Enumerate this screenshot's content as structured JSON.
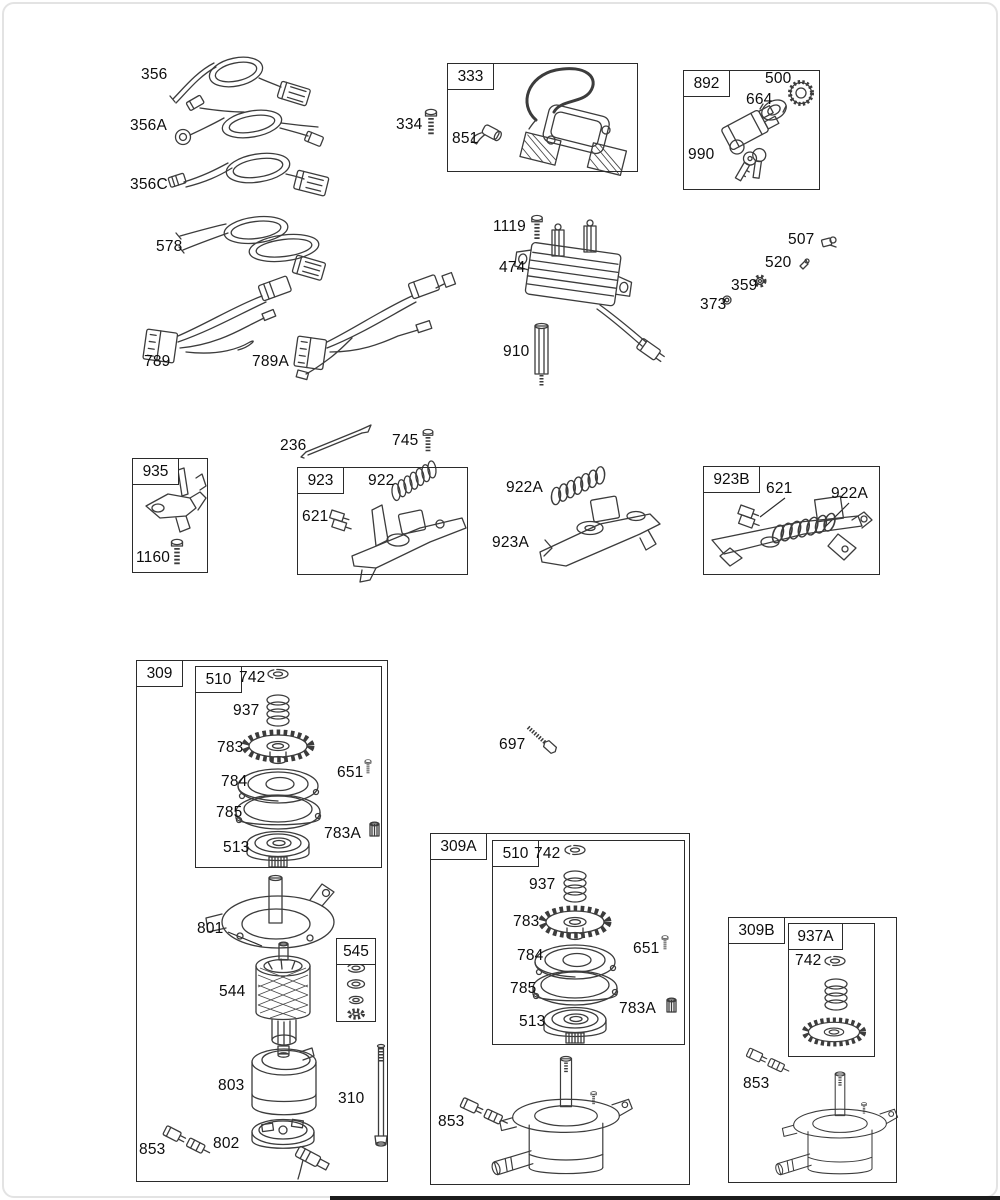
{
  "colors": {
    "ink": "#3c3c3c",
    "label_text": "#0d0d0d",
    "box_border": "#2b2b2b"
  },
  "labels": [
    {
      "id": "356",
      "text": "356",
      "x": 141,
      "y": 66
    },
    {
      "id": "356a",
      "text": "356A",
      "x": 130,
      "y": 117
    },
    {
      "id": "356c",
      "text": "356C",
      "x": 130,
      "y": 176
    },
    {
      "id": "578",
      "text": "578",
      "x": 156,
      "y": 238
    },
    {
      "id": "334",
      "text": "334",
      "x": 396,
      "y": 116
    },
    {
      "id": "851",
      "text": "851",
      "x": 452,
      "y": 130
    },
    {
      "id": "500",
      "text": "500",
      "x": 765,
      "y": 70
    },
    {
      "id": "664",
      "text": "664",
      "x": 746,
      "y": 91
    },
    {
      "id": "990",
      "text": "990",
      "x": 688,
      "y": 146
    },
    {
      "id": "1119",
      "text": "1119",
      "x": 493,
      "y": 218
    },
    {
      "id": "474",
      "text": "474",
      "x": 499,
      "y": 259
    },
    {
      "id": "910",
      "text": "910",
      "x": 503,
      "y": 343
    },
    {
      "id": "507",
      "text": "507",
      "x": 788,
      "y": 231
    },
    {
      "id": "520",
      "text": "520",
      "x": 765,
      "y": 254
    },
    {
      "id": "359",
      "text": "359",
      "x": 731,
      "y": 277
    },
    {
      "id": "373",
      "text": "373",
      "x": 700,
      "y": 296
    },
    {
      "id": "789",
      "text": "789",
      "x": 144,
      "y": 353
    },
    {
      "id": "789a",
      "text": "789A",
      "x": 252,
      "y": 353
    },
    {
      "id": "236",
      "text": "236",
      "x": 280,
      "y": 437
    },
    {
      "id": "745",
      "text": "745",
      "x": 392,
      "y": 432
    },
    {
      "id": "1160",
      "text": "1160",
      "x": 136,
      "y": 549
    },
    {
      "id": "922",
      "text": "922",
      "x": 368,
      "y": 472
    },
    {
      "id": "621-923",
      "text": "621",
      "x": 302,
      "y": 508
    },
    {
      "id": "922a",
      "text": "922A",
      "x": 506,
      "y": 479
    },
    {
      "id": "923a",
      "text": "923A",
      "x": 492,
      "y": 534
    },
    {
      "id": "621-923b",
      "text": "621",
      "x": 766,
      "y": 480
    },
    {
      "id": "922a-923b",
      "text": "922A",
      "x": 831,
      "y": 485
    },
    {
      "id": "742-309",
      "text": "742",
      "x": 239,
      "y": 669
    },
    {
      "id": "937-309",
      "text": "937",
      "x": 233,
      "y": 702
    },
    {
      "id": "783-309",
      "text": "783",
      "x": 217,
      "y": 739
    },
    {
      "id": "784-309",
      "text": "784",
      "x": 221,
      "y": 773
    },
    {
      "id": "785-309",
      "text": "785",
      "x": 216,
      "y": 804
    },
    {
      "id": "513-309",
      "text": "513",
      "x": 223,
      "y": 839
    },
    {
      "id": "651-309",
      "text": "651",
      "x": 337,
      "y": 764
    },
    {
      "id": "783a-309",
      "text": "783A",
      "x": 324,
      "y": 825
    },
    {
      "id": "801",
      "text": "801",
      "x": 197,
      "y": 920
    },
    {
      "id": "544",
      "text": "544",
      "x": 219,
      "y": 983
    },
    {
      "id": "803",
      "text": "803",
      "x": 218,
      "y": 1077
    },
    {
      "id": "310",
      "text": "310",
      "x": 338,
      "y": 1090
    },
    {
      "id": "802",
      "text": "802",
      "x": 213,
      "y": 1135
    },
    {
      "id": "853-309",
      "text": "853",
      "x": 139,
      "y": 1141
    },
    {
      "id": "697",
      "text": "697",
      "x": 499,
      "y": 736
    },
    {
      "id": "742-309a",
      "text": "742",
      "x": 534,
      "y": 845
    },
    {
      "id": "937-309a",
      "text": "937",
      "x": 529,
      "y": 876
    },
    {
      "id": "783-309a",
      "text": "783",
      "x": 513,
      "y": 913
    },
    {
      "id": "784-309a",
      "text": "784",
      "x": 517,
      "y": 947
    },
    {
      "id": "785-309a",
      "text": "785",
      "x": 510,
      "y": 980
    },
    {
      "id": "513-309a",
      "text": "513",
      "x": 519,
      "y": 1013
    },
    {
      "id": "651-309a",
      "text": "651",
      "x": 633,
      "y": 940
    },
    {
      "id": "783a-309a",
      "text": "783A",
      "x": 619,
      "y": 1000
    },
    {
      "id": "853-309a",
      "text": "853",
      "x": 438,
      "y": 1113
    },
    {
      "id": "742-937a",
      "text": "742",
      "x": 795,
      "y": 952
    },
    {
      "id": "853-309b",
      "text": "853",
      "x": 743,
      "y": 1075
    }
  ],
  "boxes": [
    {
      "id": "333",
      "tag": "333",
      "x": 447,
      "y": 63,
      "w": 191,
      "h": 109,
      "tw": 46
    },
    {
      "id": "892",
      "tag": "892",
      "x": 683,
      "y": 70,
      "w": 137,
      "h": 120,
      "tw": 46
    },
    {
      "id": "935",
      "tag": "935",
      "x": 132,
      "y": 458,
      "w": 76,
      "h": 115,
      "tw": 46
    },
    {
      "id": "923",
      "tag": "923",
      "x": 297,
      "y": 467,
      "w": 171,
      "h": 108,
      "tw": 46
    },
    {
      "id": "923b",
      "tag": "923B",
      "x": 703,
      "y": 466,
      "w": 177,
      "h": 109,
      "tw": 56
    },
    {
      "id": "309",
      "tag": "309",
      "x": 136,
      "y": 660,
      "w": 252,
      "h": 522,
      "tw": 46
    },
    {
      "id": "510-309",
      "tag": "510",
      "x": 195,
      "y": 666,
      "w": 187,
      "h": 202,
      "tw": 46
    },
    {
      "id": "545",
      "tag": "545",
      "x": 336,
      "y": 938,
      "w": 40,
      "h": 84,
      "tw": 40,
      "header": true
    },
    {
      "id": "309a",
      "tag": "309A",
      "x": 430,
      "y": 833,
      "w": 260,
      "h": 352,
      "tw": 56
    },
    {
      "id": "510-309a",
      "tag": "510",
      "x": 492,
      "y": 840,
      "w": 193,
      "h": 205,
      "tw": 46
    },
    {
      "id": "309b",
      "tag": "309B",
      "x": 728,
      "y": 917,
      "w": 169,
      "h": 266,
      "tw": 56
    },
    {
      "id": "937a",
      "tag": "937A",
      "x": 788,
      "y": 923,
      "w": 87,
      "h": 134,
      "tw": 54
    }
  ],
  "crop_edge": {
    "x": 330,
    "y": 1196,
    "w": 670,
    "h": 4
  }
}
